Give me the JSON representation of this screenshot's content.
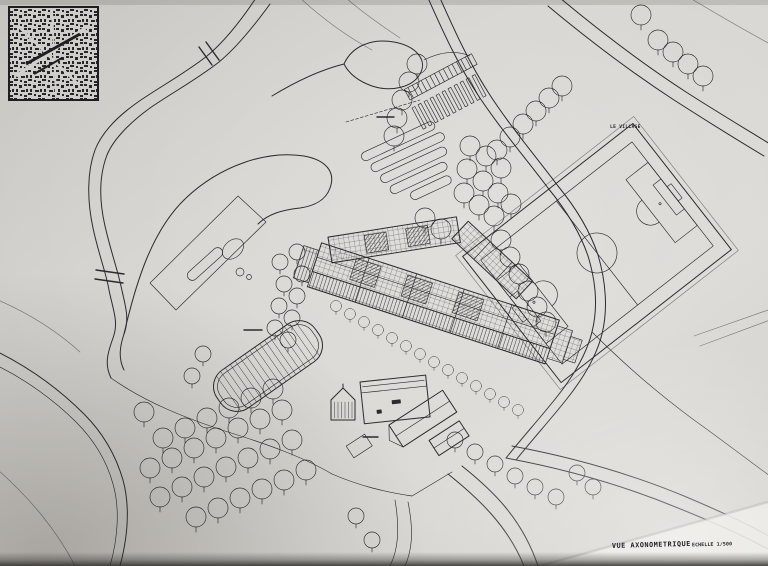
{
  "caption": {
    "title": "VUE AXONOMETRIQUE",
    "scale": "ECHELLE 1/500"
  },
  "labels": {
    "village": "LE VILLAGE"
  },
  "colors": {
    "paper": "#d6d4d0",
    "paper_light": "#e9e7e3",
    "ink": "#2b2b30",
    "bottom_shadow": "#2e2c29"
  }
}
